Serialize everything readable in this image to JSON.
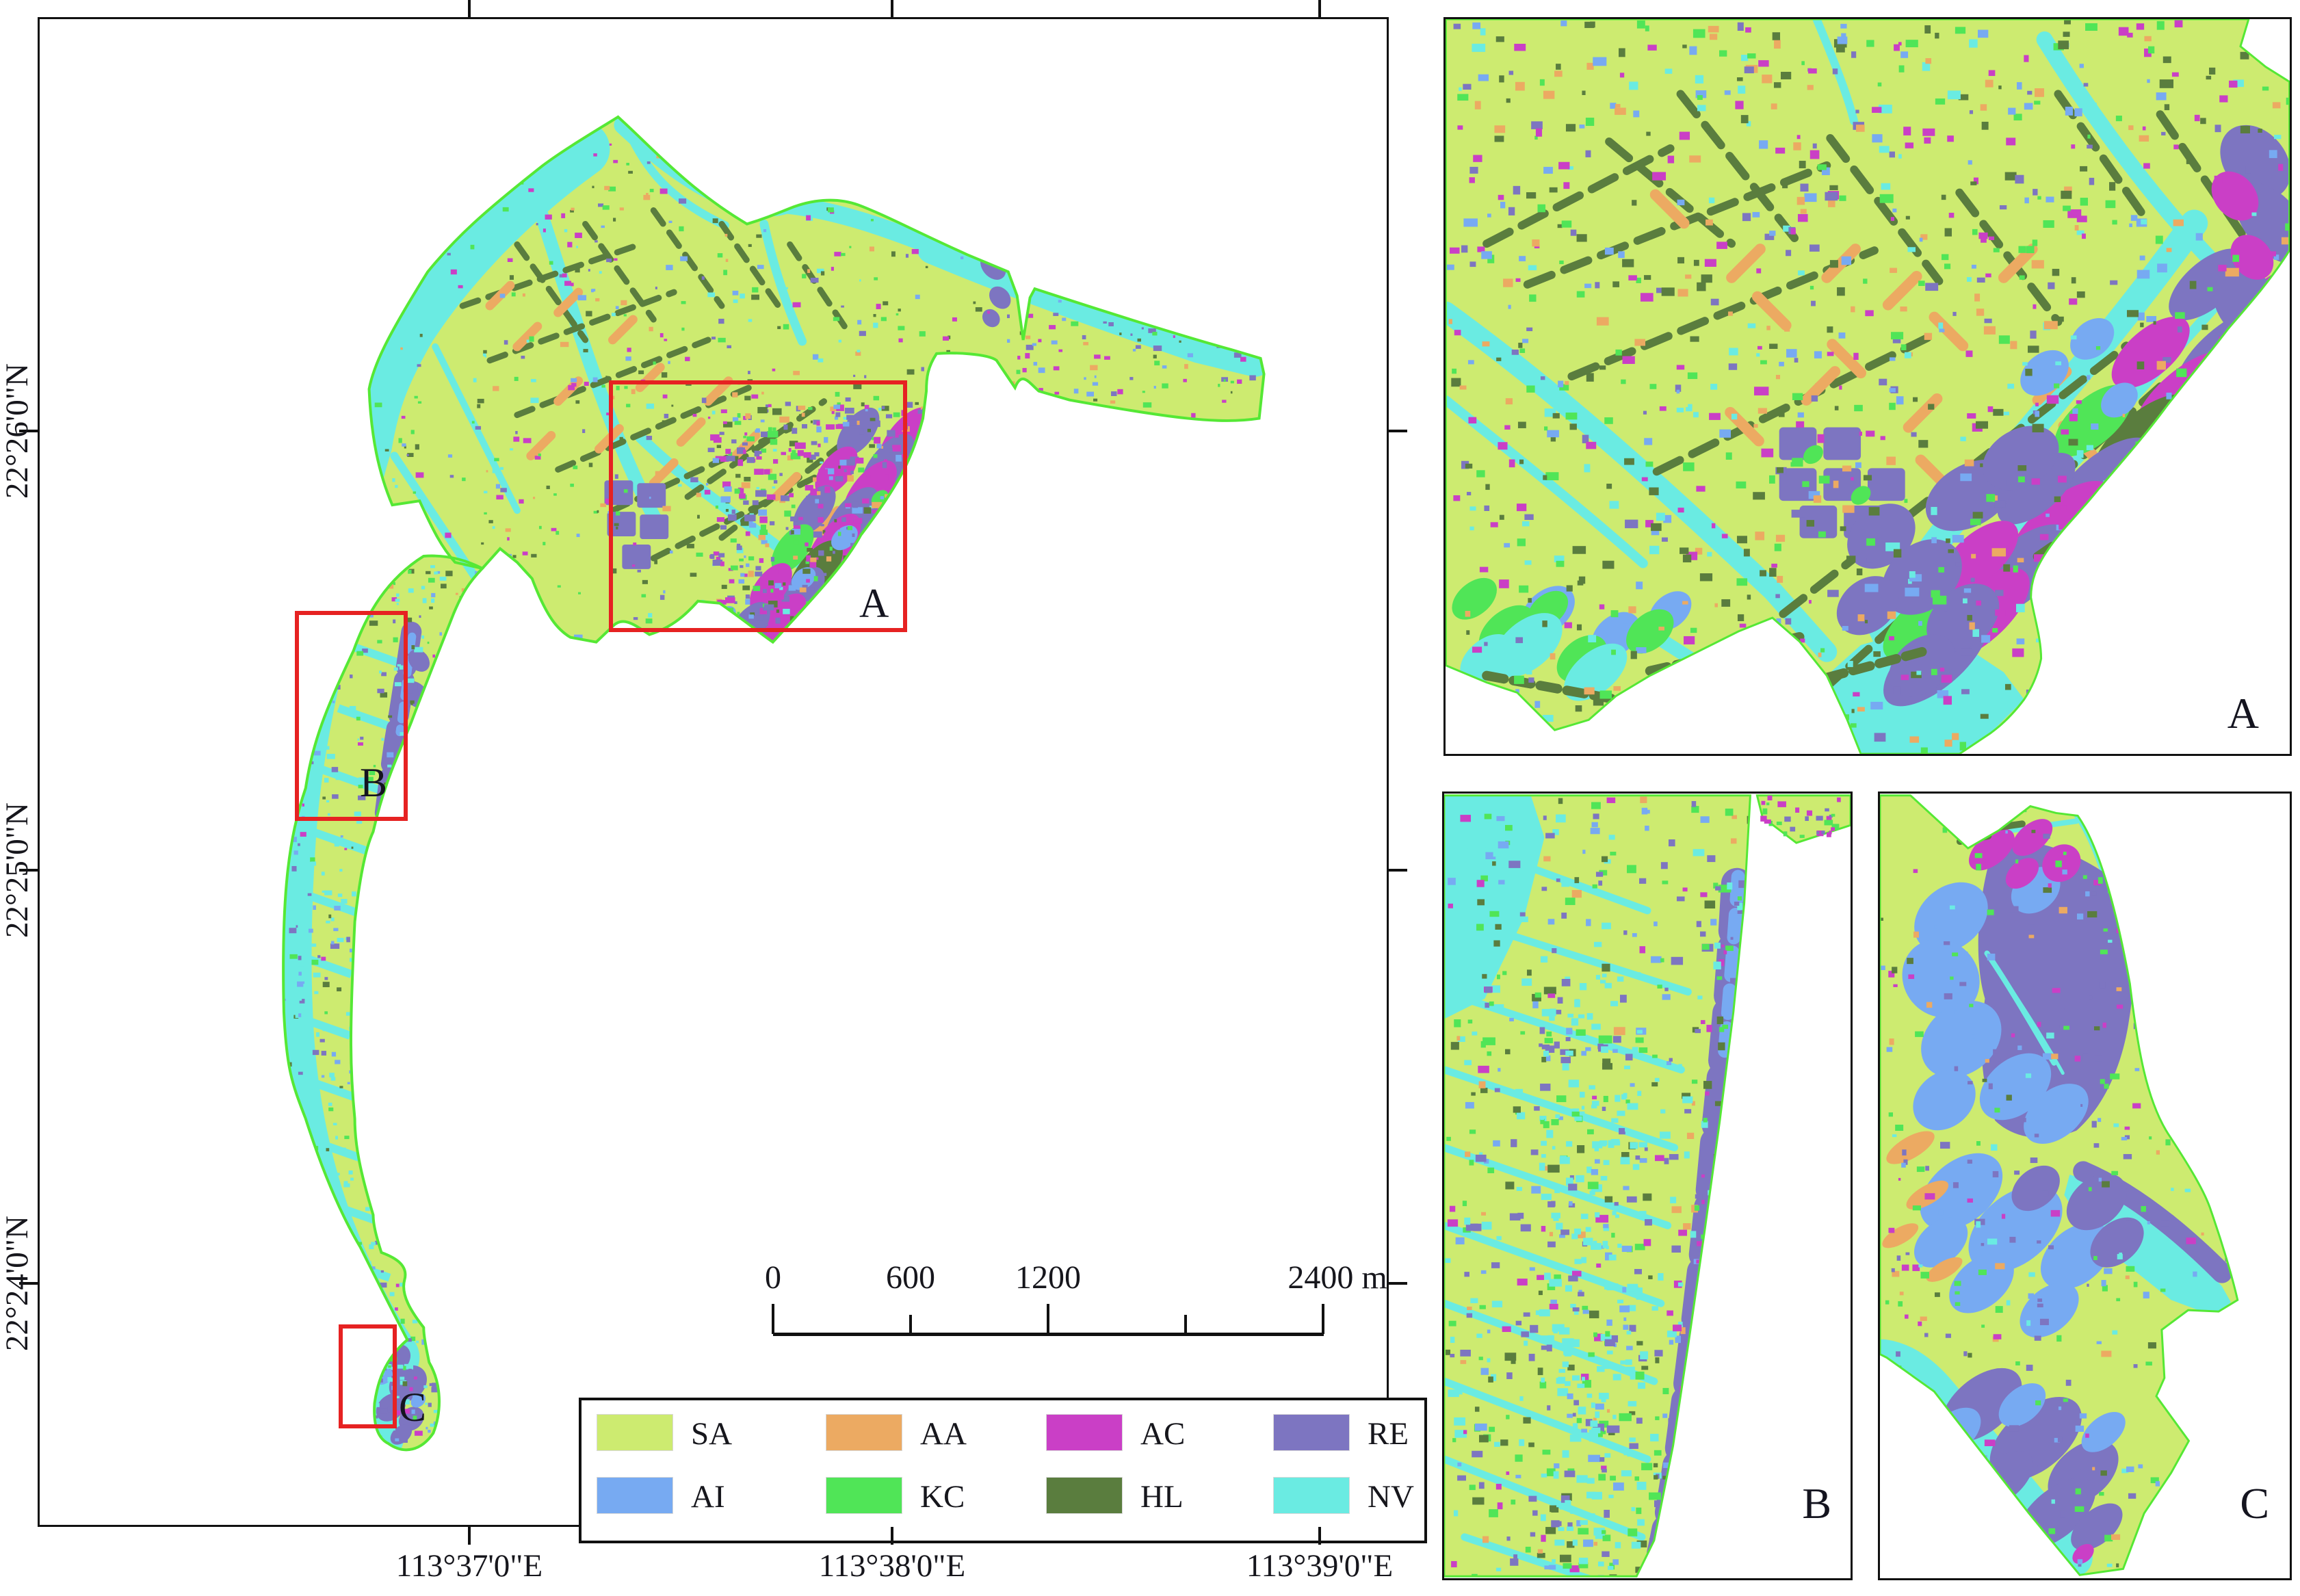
{
  "figure": {
    "description": "Land cover classification map with three enlarged regions"
  },
  "colors": {
    "sa": "#cdeb70",
    "aa": "#ecaa62",
    "ac": "#ca3fc6",
    "re": "#7d75c1",
    "ai": "#77aaf2",
    "kc": "#50e557",
    "hl": "#5a7d3e",
    "nv": "#6aebe2",
    "boundary": "#55e835",
    "red_box": "#e62222",
    "frame": "#111111"
  },
  "main_map": {
    "x_ticks": [
      {
        "label": "113°37'0\"E"
      },
      {
        "label": "113°38'0\"E"
      },
      {
        "label": "113°39'0\"E"
      }
    ],
    "y_ticks": [
      {
        "label": "22°26'0\"N"
      },
      {
        "label": "22°25'0\"N"
      },
      {
        "label": "22°24'0\"N"
      }
    ],
    "regions": [
      {
        "id": "A"
      },
      {
        "id": "B"
      },
      {
        "id": "C"
      }
    ],
    "scale_bar": {
      "tick_labels": [
        "0",
        "600",
        "1200"
      ],
      "end_label": "2400 m"
    }
  },
  "legend": {
    "items": [
      {
        "code": "SA",
        "color": "#cdeb70"
      },
      {
        "code": "AA",
        "color": "#ecaa62"
      },
      {
        "code": "AC",
        "color": "#ca3fc6"
      },
      {
        "code": "RE",
        "color": "#7d75c1"
      },
      {
        "code": "AI",
        "color": "#77aaf2"
      },
      {
        "code": "KC",
        "color": "#50e557"
      },
      {
        "code": "HL",
        "color": "#5a7d3e"
      },
      {
        "code": "NV",
        "color": "#6aebe2"
      }
    ]
  },
  "panels": [
    {
      "id": "A"
    },
    {
      "id": "B"
    },
    {
      "id": "C"
    }
  ]
}
